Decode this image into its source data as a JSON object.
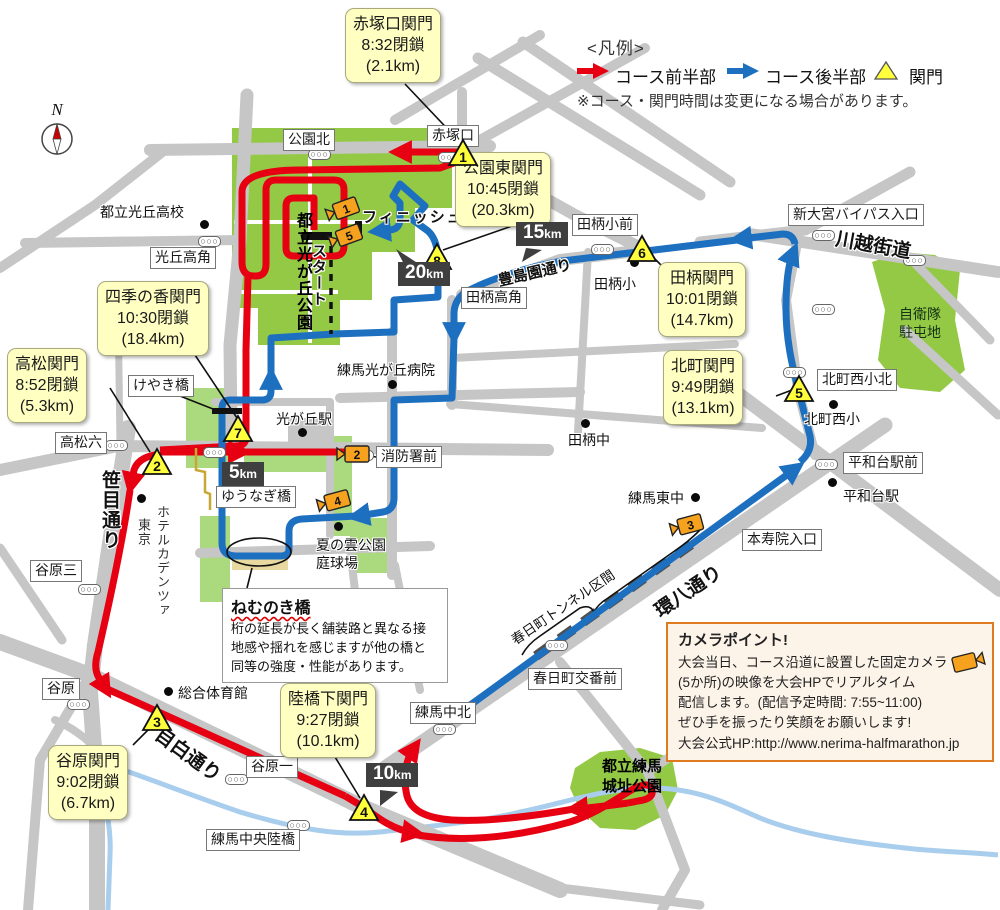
{
  "legend": {
    "title": "<凡例>",
    "first_half": "コース前半部",
    "second_half": "コース後半部",
    "checkpoint": "関門",
    "note": "※コース・関門時間は変更になる場合があります。"
  },
  "compass_label": "N",
  "course": {
    "start": "スタート",
    "finish": "フィニッシュ"
  },
  "callouts": [
    {
      "no": "1",
      "title": "赤塚口関門",
      "time": "8:32閉鎖",
      "distance": "(2.1km)"
    },
    {
      "no": "2",
      "title": "高松関門",
      "time": "8:52閉鎖",
      "distance": "(5.3km)"
    },
    {
      "no": "3",
      "title": "谷原関門",
      "time": "9:02閉鎖",
      "distance": "(6.7km)"
    },
    {
      "no": "4",
      "title": "陸橋下関門",
      "time": "9:27閉鎖",
      "distance": "(10.1km)"
    },
    {
      "no": "5",
      "title": "北町関門",
      "time": "9:49閉鎖",
      "distance": "(13.1km)"
    },
    {
      "no": "6",
      "title": "田柄関門",
      "time": "10:01閉鎖",
      "distance": "(14.7km)"
    },
    {
      "no": "7",
      "title": "四季の香関門",
      "time": "10:30閉鎖",
      "distance": "(18.4km)"
    },
    {
      "no": "8",
      "title": "公園東関門",
      "time": "10:45閉鎖",
      "distance": "(20.3km)"
    }
  ],
  "checkpoint_numbers": [
    "1",
    "2",
    "3",
    "4",
    "5",
    "6",
    "7",
    "8"
  ],
  "camera_numbers": [
    "1",
    "2",
    "3",
    "4",
    "5"
  ],
  "km_markers": [
    {
      "value": "5",
      "unit": "km"
    },
    {
      "value": "10",
      "unit": "km"
    },
    {
      "value": "15",
      "unit": "km"
    },
    {
      "value": "20",
      "unit": "km"
    }
  ],
  "roads": {
    "sasame": "笹目通り",
    "mejiro": "目白通り",
    "kanpachi": "環八通り",
    "kawagoe": "川越街道",
    "toshimaen": "豊島園通り",
    "tunnel": "春日町トンネル区間"
  },
  "places": {
    "koenkita": "公園北",
    "akatsukaguchi": "赤塚口",
    "hikarigaokakado": "光丘高角",
    "takamatsu6": "高松六",
    "yawara3": "谷原三",
    "yawara": "谷原",
    "yawara1": "谷原一",
    "nerima_chuo_rikkyo": "練馬中央陸橋",
    "nerima_nakakita": "練馬中北",
    "kasugacho_koban": "春日町交番前",
    "honjuin": "本寿院入口",
    "heiwadai_ekimae": "平和台駅前",
    "kitamachi_nishi_sho_kita": "北町西小北",
    "tagara_sho_mae": "田柄小前",
    "tagara_takakado": "田柄高角",
    "shin_omiya": "新大宮バイパス入口",
    "shobosho_mae": "消防署前",
    "keyakibashi": "けやき橋",
    "yunagibashi": "ゆうなぎ橋"
  },
  "pois": {
    "hikarigaoka_hs": "都立光丘高校",
    "hikarigaoka_hosp": "練馬光が丘病院",
    "tagara_sho": "田柄小",
    "tagara_chu": "田柄中",
    "nerima_higashi_chu": "練馬東中",
    "heiwadai_sta": "平和台駅",
    "kitamachi_nishi_sho": "北町西小",
    "sogo_taiikukan": "総合体育館",
    "natsunokumo1": "夏の雲公園",
    "natsunokumo2": "庭球場",
    "hikarigaoka_sta": "光が丘駅",
    "hotel1": "ホテルカデンツァ",
    "hotel2": "東京"
  },
  "parks": {
    "hikarigaoka": "都立光が丘公園",
    "jieitai1": "自衛隊",
    "jieitai2": "駐屯地",
    "nerimajo1": "都立練馬",
    "nerimajo2": "城址公園"
  },
  "nemunoki": {
    "title": "ねむのき橋",
    "line1": "桁の延長が長く舗装路と異なる接",
    "line2": "地感や揺れを感じますが他の橋と",
    "line3": "同等の強度・性能があります。"
  },
  "camera_info": {
    "title": "カメラポイント!",
    "line1": "大会当日、コース沿道に設置した固定カメラ",
    "line2": "(5か所)の映像を大会HPでリアルタイム",
    "line3": "配信します。(配信予定時間: 7:55~11:00)",
    "line4": "ぜひ手を振ったり笑顔をお願いします!",
    "line5": "大会公式HP:http://www.nerima-halfmarathon.jp"
  },
  "colors": {
    "course_first_half": "#e60012",
    "course_second_half": "#1d6fbf",
    "checkpoint_yellow": "#ffff3c",
    "callout_yellow": "#ffffc2",
    "camera_orange": "#f6a21f",
    "park_green": "#94c946",
    "road_gray": "#c6c6c6",
    "river_blue": "#a9cdec"
  }
}
